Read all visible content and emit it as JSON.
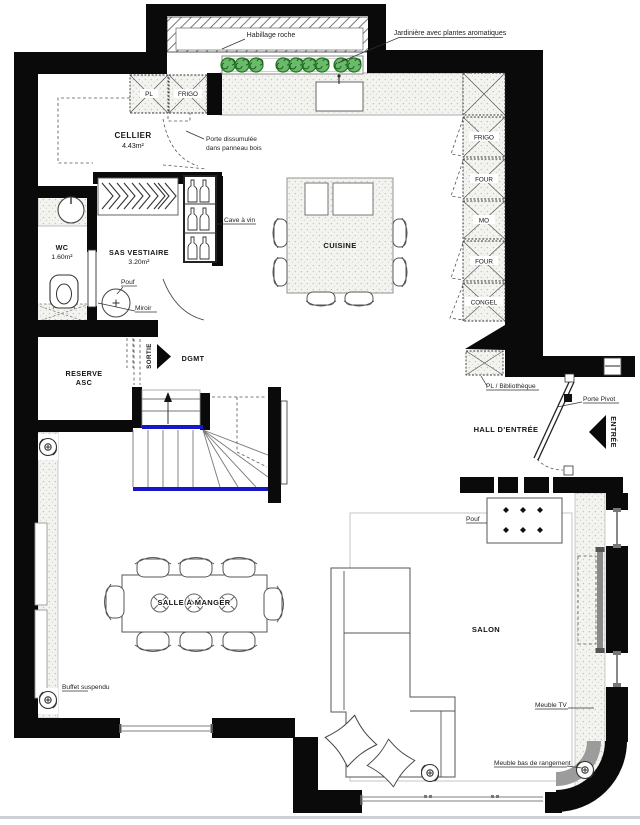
{
  "rooms": {
    "cellier": {
      "name": "CELLIER",
      "area": "4.43m²"
    },
    "wc": {
      "name": "WC",
      "area": "1.60m²"
    },
    "sas_vestiaire": {
      "name": "SAS VESTIAIRE",
      "area": "3.20m²"
    },
    "cuisine": {
      "name": "CUISINE"
    },
    "reserve_asc": {
      "line1": "RESERVE",
      "line2": "ASC"
    },
    "dgmt": {
      "name": "DGMT"
    },
    "hall_entree": {
      "name": "HALL D'ENTRÉE"
    },
    "salle_a_manger": {
      "name": "SALLE À MANGER"
    },
    "salon": {
      "name": "SALON"
    }
  },
  "cabinets": {
    "pl": "PL",
    "frigo": "FRIGO"
  },
  "appliance_column": [
    "FRIGO",
    "FOUR",
    "MO",
    "FOUR",
    "CONGEL"
  ],
  "annotations": {
    "habillage_roche": "Habillage roche",
    "jardiniere": "Jardinière avec plantes aromatiques",
    "porte_dissimulee_l1": "Porte dissumulée",
    "porte_dissimulee_l2": "dans panneau bois",
    "cave_a_vin": "Cave à vin",
    "pouf_sas": "Pouf",
    "miroir": "Miroir",
    "sortie": "SORTIE",
    "entree": "ENTRÉE",
    "porte_pivot": "Porte Pivot",
    "pl_bibliotheque": "PL / Bibliothèque",
    "pouf_salon": "Pouf",
    "buffet_suspendu": "Buffet suspendu",
    "meuble_tv": "Meuble TV",
    "meuble_bas_rangement": "Meuble bas de rangement"
  },
  "colors": {
    "wall": "#0a0a0a",
    "stair_edge_blue": "#1717c9",
    "plant_green": "#58a758",
    "window_frame": "#9a9a9a",
    "footer_line": "#ccd1d9"
  }
}
